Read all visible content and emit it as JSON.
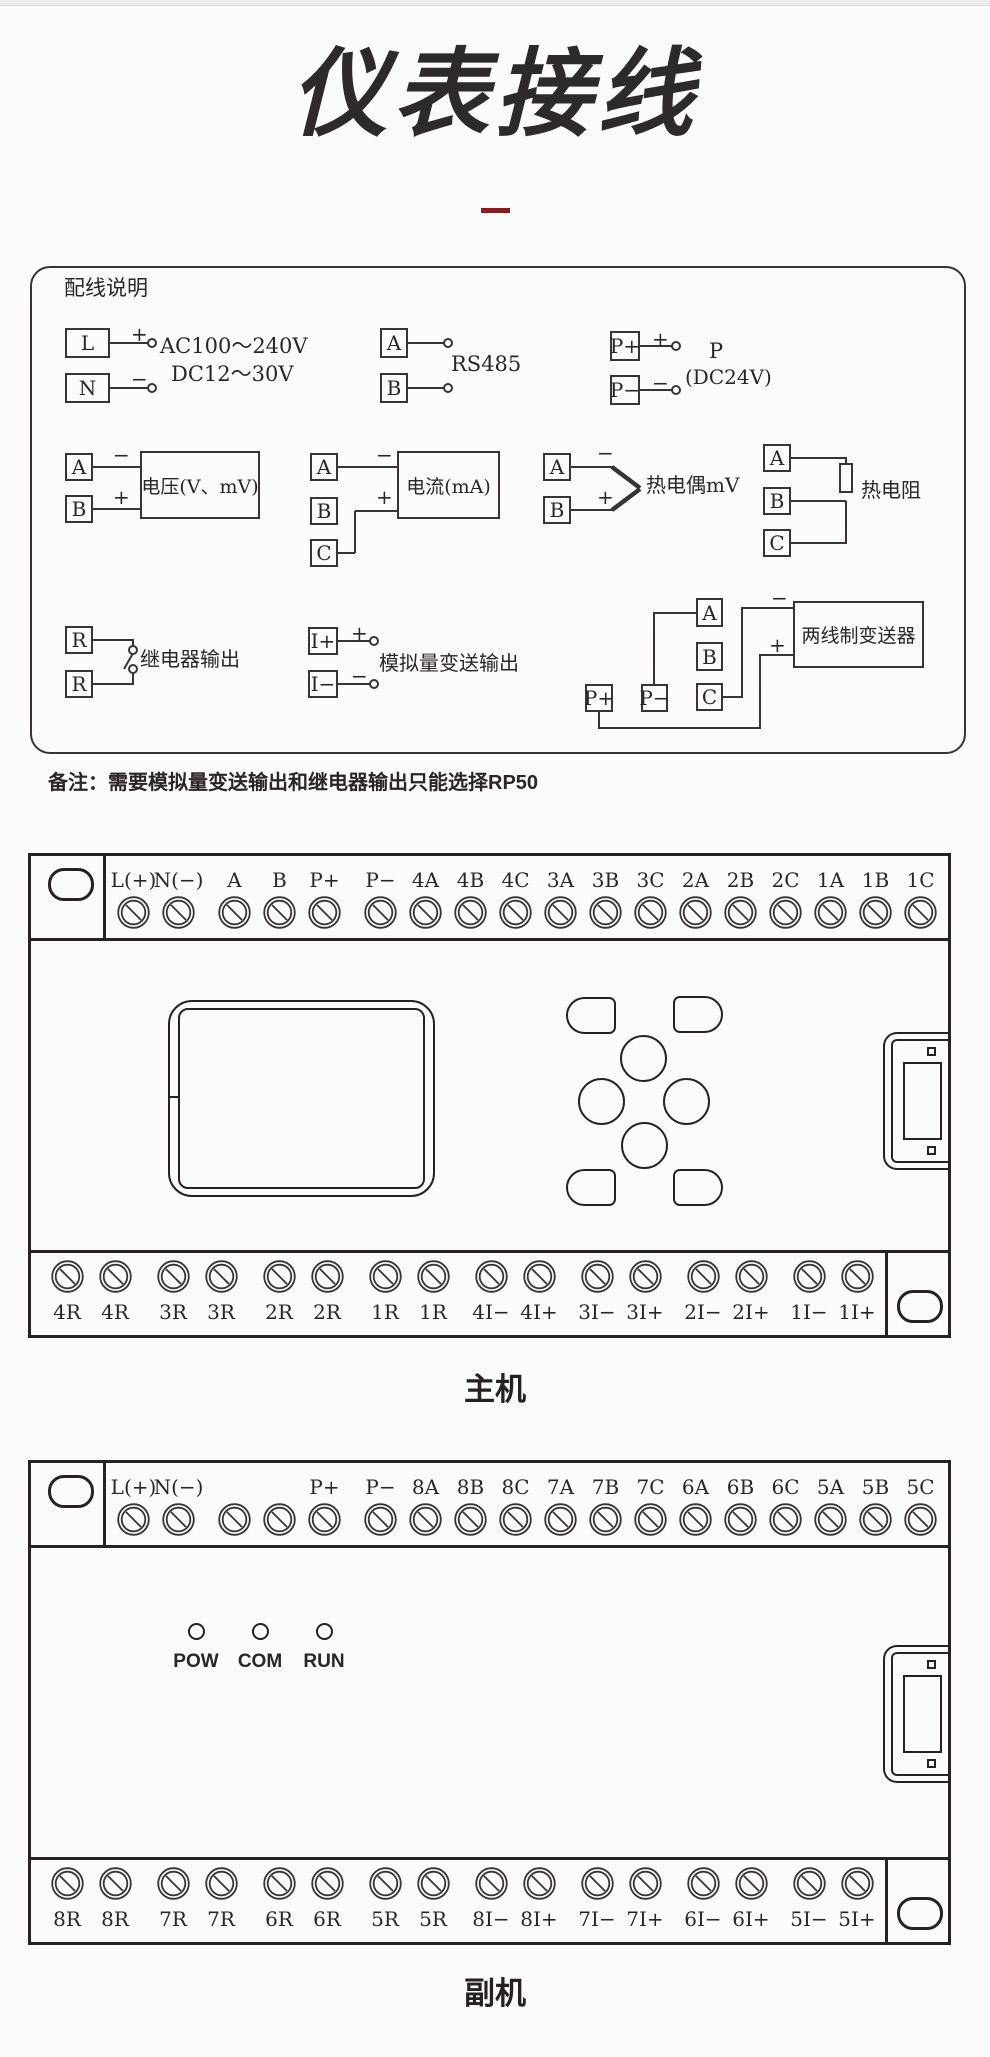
{
  "page": {
    "title": "仪表接线",
    "note": "备注：需要模拟量变送输出和继电器输出只能选择RP50"
  },
  "wiring": {
    "heading": "配线说明",
    "power": {
      "t1": "L",
      "t2": "N",
      "plus": "+",
      "minus": "−",
      "volts1": "AC100～240V",
      "volts2": "DC12～30V"
    },
    "rs485": {
      "t1": "A",
      "t2": "B",
      "label": "RS485"
    },
    "aux_power": {
      "t1": "P+",
      "t2": "P−",
      "plus": "+",
      "minus": "−",
      "name": "P",
      "volts": "(DC24V)"
    },
    "voltage_in": {
      "t1": "A",
      "t2": "B",
      "minus": "−",
      "plus": "+",
      "label": "电压(V、mV)"
    },
    "current_in": {
      "t1": "A",
      "t2": "B",
      "t3": "C",
      "minus": "−",
      "plus": "+",
      "label": "电流(mA)"
    },
    "thermocouple": {
      "t1": "A",
      "t2": "B",
      "minus": "−",
      "plus": "+",
      "label": "热电偶mV"
    },
    "rtd": {
      "t1": "A",
      "t2": "B",
      "t3": "C",
      "label": "热电阻"
    },
    "relay": {
      "t1": "R",
      "t2": "R",
      "label": "继电器输出"
    },
    "analog_out": {
      "t1": "I+",
      "t2": "I−",
      "plus": "+",
      "minus": "−",
      "label": "模拟量变送输出"
    },
    "transmitter": {
      "tA": "A",
      "tB": "B",
      "tC": "C",
      "tP1": "P+",
      "tP2": "P−",
      "minus": "−",
      "plus": "+",
      "label": "两线制变送器"
    }
  },
  "main_unit": {
    "caption": "主机",
    "top_terminals": [
      "L(+)",
      "N(−)",
      "A",
      "B",
      "P+",
      "P−",
      "4A",
      "4B",
      "4C",
      "3A",
      "3B",
      "3C",
      "2A",
      "2B",
      "2C",
      "1A",
      "1B",
      "1C"
    ],
    "bottom_terminals": [
      "4R",
      "4R",
      "3R",
      "3R",
      "2R",
      "2R",
      "1R",
      "1R",
      "4I−",
      "4I+",
      "3I−",
      "3I+",
      "2I−",
      "2I+",
      "1I−",
      "1I+"
    ]
  },
  "secondary_unit": {
    "caption": "副机",
    "top_terminals": [
      "L(+)",
      "N(−)",
      "",
      "",
      "P+",
      "P−",
      "8A",
      "8B",
      "8C",
      "7A",
      "7B",
      "7C",
      "6A",
      "6B",
      "6C",
      "5A",
      "5B",
      "5C"
    ],
    "leds": [
      "POW",
      "COM",
      "RUN"
    ],
    "bottom_terminals": [
      "8R",
      "8R",
      "7R",
      "7R",
      "6R",
      "6R",
      "5R",
      "5R",
      "8I−",
      "8I+",
      "7I−",
      "7I+",
      "6I−",
      "6I+",
      "5I−",
      "5I+"
    ]
  }
}
